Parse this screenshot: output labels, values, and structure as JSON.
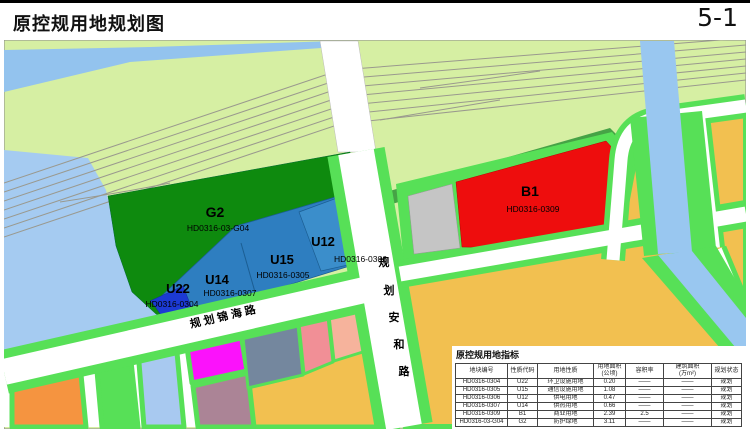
{
  "page": {
    "title": "原控规用地规划图",
    "sheet_no": "5-1"
  },
  "map": {
    "zones": [
      {
        "id": "G2",
        "code": "HD0316-03-G04",
        "use": "防护绿地",
        "color": "#0e8a0e"
      },
      {
        "id": "U12",
        "code": "HD0316-0306",
        "use": "供电用地",
        "color": "#3b8ecb"
      },
      {
        "id": "U15",
        "code": "HD0316-0305",
        "use": "通信设施用地",
        "color": "#2e7ec0"
      },
      {
        "id": "U14",
        "code": "HD0316-0307",
        "use": "供热用地",
        "color": "#2e7ec0"
      },
      {
        "id": "U22",
        "code": "HD0316-0304",
        "use": "环卫设施用地",
        "color": "#1c3ad4"
      },
      {
        "id": "B1",
        "code": "HD0316-0309",
        "use": "商业用地",
        "color": "#ee0d0d"
      }
    ],
    "roads": {
      "anhe": {
        "label": "规划安和路",
        "chars": [
          "规",
          "划",
          "安",
          "和",
          "路"
        ]
      },
      "jinhai": {
        "label": "规划锦海路"
      }
    },
    "legend_colors": {
      "background_green": "#d6efa3",
      "water_blue": "#a5cbf1",
      "canal_blue": "#99c7f0",
      "verge_green": "#57e057",
      "buffer_green": "#46a346",
      "commercial_red": "#ee0d0d",
      "utility_blue": "#2e7ec0",
      "park_green": "#0e8a0e",
      "amber_parcel": "#f2c050",
      "gray_parcel": "#c5c5c5"
    }
  },
  "table": {
    "title": "原控规用地指标",
    "headers": [
      "地块编号",
      "性质代码",
      "用地性质",
      "用地面积\n(公顷)",
      "容积率",
      "建筑面积\n(万m²)",
      "规划状态"
    ],
    "rows": [
      [
        "HD0316-0304",
        "U22",
        "环卫设施用地",
        "0.20",
        "——",
        "——",
        "规划"
      ],
      [
        "HD0316-0305",
        "U15",
        "通信设施用地",
        "1.08",
        "——",
        "——",
        "规划"
      ],
      [
        "HD0316-0306",
        "U12",
        "供电用地",
        "0.47",
        "——",
        "——",
        "规划"
      ],
      [
        "HD0316-0307",
        "U14",
        "供热用地",
        "0.66",
        "——",
        "——",
        "规划"
      ],
      [
        "HD0316-0309",
        "B1",
        "商业用地",
        "2.39",
        "2.5",
        "——",
        "规划"
      ],
      [
        "HD0316-03-G04",
        "G2",
        "防护绿地",
        "3.11",
        "——",
        "——",
        "规划"
      ]
    ]
  }
}
